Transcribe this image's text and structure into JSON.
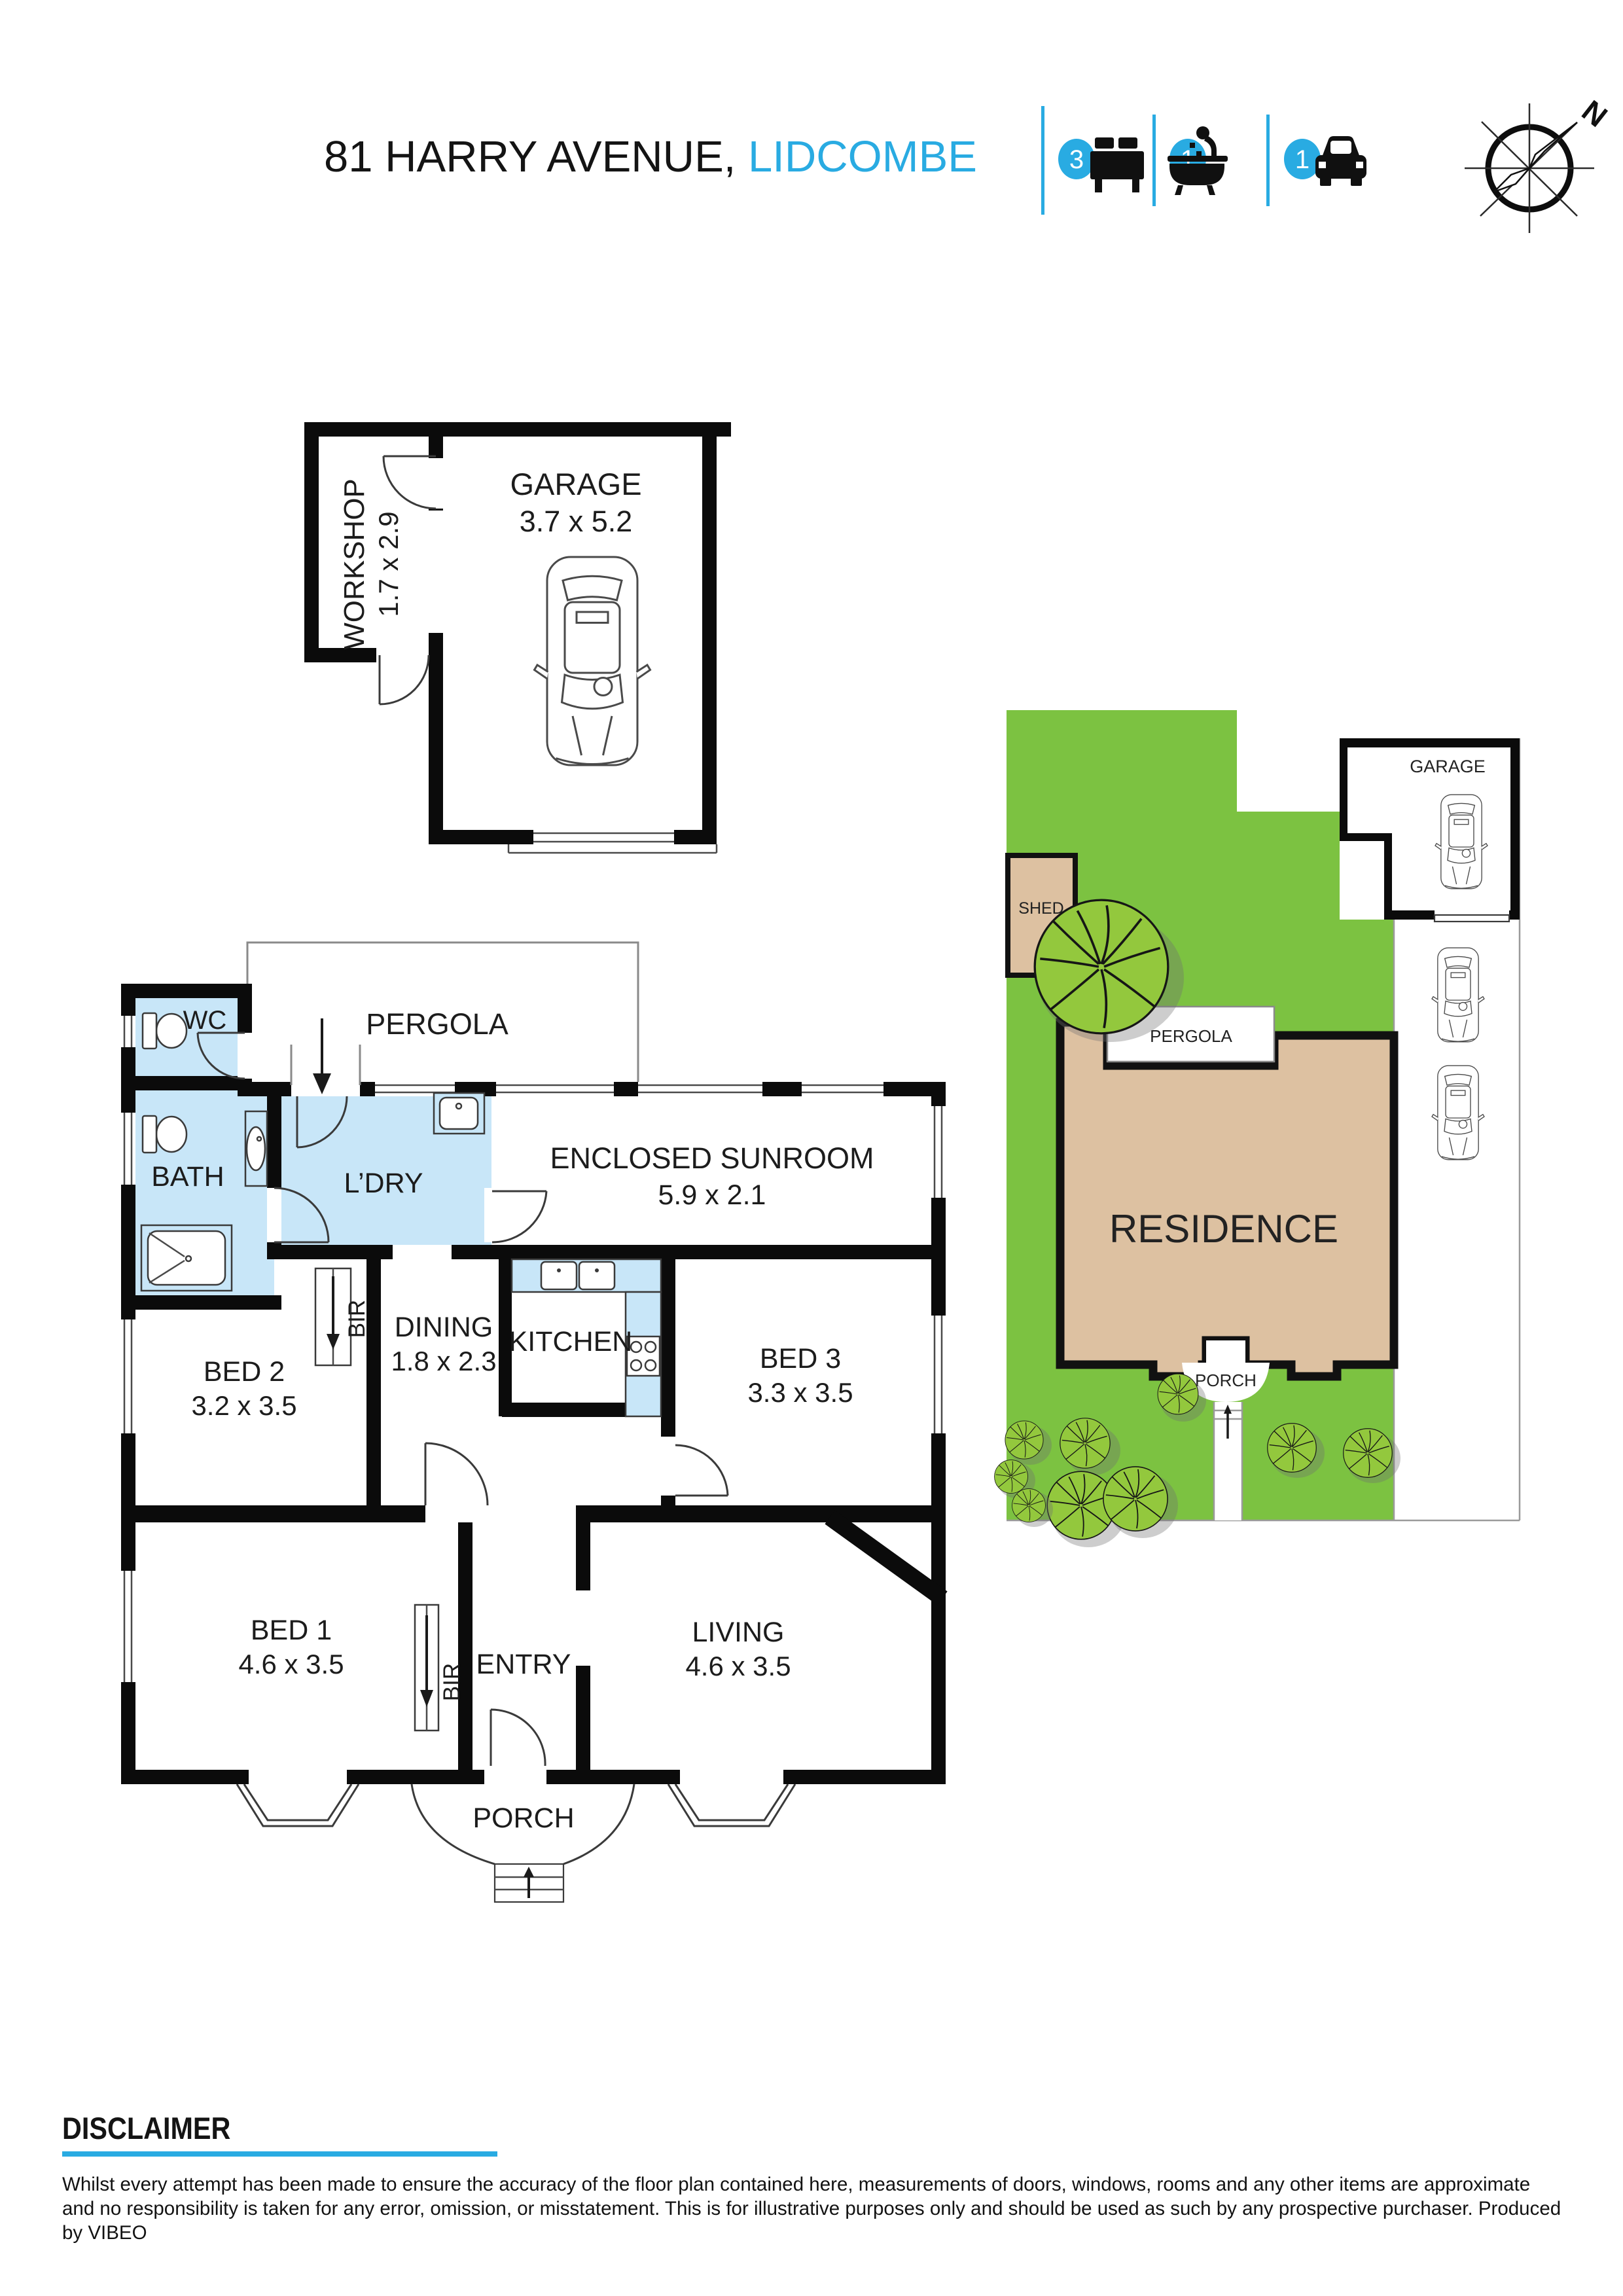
{
  "header": {
    "address_black": "81 HARRY AVENUE,",
    "address_blue": "LIDCOMBE",
    "stats": [
      {
        "count": "3",
        "icon": "bed-icon"
      },
      {
        "count": "1",
        "icon": "bath-icon"
      },
      {
        "count": "1",
        "icon": "car-icon"
      }
    ],
    "compass_n": "N"
  },
  "garage_plan": {
    "workshop": {
      "label": "WORKSHOP",
      "dim": "1.7 x 2.9"
    },
    "garage": {
      "label": "GARAGE",
      "dim": "3.7 x 5.2"
    }
  },
  "floor_plan": {
    "wc": "WC",
    "pergola": "PERGOLA",
    "bath": "BATH",
    "laundry": "L’DRY",
    "sunroom": {
      "label": "ENCLOSED SUNROOM",
      "dim": "5.9 x 2.1"
    },
    "bed2": {
      "label": "BED 2",
      "dim": "3.2 x 3.5"
    },
    "bir_bed2": "BIR",
    "dining": {
      "label": "DINING",
      "dim": "1.8 x 2.3"
    },
    "kitchen": "KITCHEN",
    "bed3": {
      "label": "BED 3",
      "dim": "3.3 x 3.5"
    },
    "bed1": {
      "label": "BED 1",
      "dim": "4.6 x 3.5"
    },
    "bir_bed1": "BIR",
    "entry": "ENTRY",
    "living": {
      "label": "LIVING",
      "dim": "4.6 x 3.5"
    },
    "porch": "PORCH"
  },
  "site_plan": {
    "garage": "GARAGE",
    "shed": "SHED",
    "pergola": "PERGOLA",
    "residence": "RESIDENCE",
    "porch": "PORCH"
  },
  "disclaimer": {
    "heading": "DISCLAIMER",
    "body": "Whilst every attempt  has been made to ensure the accuracy of the floor plan contained here, measurements of doors, windows, rooms and any other items are approximate and no responsibility is taken for any error, omission, or misstatement. This is for illustrative purposes only and should be used as such by any prospective purchaser. Produced by VIBEO"
  },
  "colors": {
    "accent": "#29ABE2",
    "room_blue": "#C8E6F8",
    "lawn_green": "#7CC241",
    "tree_green": "#93C83D",
    "residence_tan": "#DDC1A1"
  }
}
